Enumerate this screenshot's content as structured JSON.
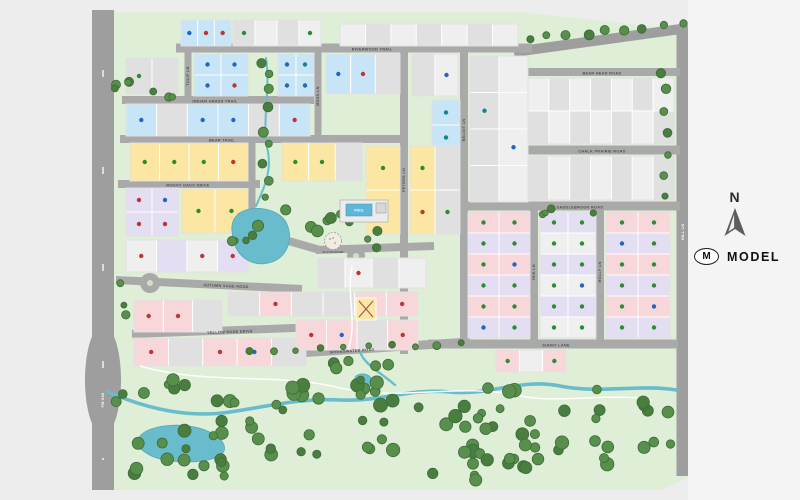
{
  "compass": {
    "label": "N"
  },
  "legend": {
    "symbol": "M",
    "label": "MODEL"
  },
  "amenities": {
    "pool": "POOL",
    "playground": "PLAYGROUND"
  },
  "map": {
    "page_bg": "#ededed",
    "panel_bg": "#f4f4f4",
    "background": "#dfeed6",
    "road_color": "#a9a9a9",
    "main_road_color": "#9e9e9e",
    "water": "#68bccc",
    "water_edge": "#57a7b8",
    "tree_fill": "#598f4c",
    "tree_fill_alt": "#4a7d40",
    "tree_stroke": "#3c6b36",
    "trail_color": "#ffffff",
    "label_color": "#4f4f4f",
    "lot_fills": {
      "blue": "#c7e5f6",
      "yellow": "#fbe7a3",
      "pink": "#f8d7da",
      "lavender": "#e4def2",
      "gray": "#e0e0e0",
      "white": "#efefef"
    },
    "dot_colors": {
      "green": "#2e8b34",
      "blue": "#2167c0",
      "red": "#bf3434",
      "teal": "#0f8792",
      "purple": "#5d3191"
    },
    "streets": [
      {
        "label": "FM 646",
        "x1": 103,
        "y1": 10,
        "x2": 103,
        "y2": 490,
        "w": 22,
        "main": true,
        "vert": true,
        "lx": 103,
        "ly": 400,
        "labelColor": "#ffffff"
      },
      {
        "label": "HILL LN",
        "x1": 683,
        "y1": 28,
        "x2": 683,
        "y2": 476,
        "w": 13,
        "main": true,
        "vert": true,
        "lx": 683,
        "ly": 232,
        "labelColor": "#ffffff"
      },
      {
        "label": "",
        "x1": 514,
        "y1": 52,
        "x2": 688,
        "y2": 28,
        "w": 10,
        "main": true
      },
      {
        "label": "RIVERWOOD TRAIL",
        "x1": 176,
        "y1": 48,
        "x2": 532,
        "y2": 48,
        "w": 9,
        "lx": 372,
        "ly": 49.4
      },
      {
        "label": "BEAR HEAD ROAD",
        "x1": 526,
        "y1": 72,
        "x2": 680,
        "y2": 72,
        "w": 8,
        "lx": 602,
        "ly": 73.4
      },
      {
        "label": "CHALK PRAIRIE ROAD",
        "x1": 526,
        "y1": 150,
        "x2": 680,
        "y2": 150,
        "w": 9,
        "lx": 602,
        "ly": 151.4
      },
      {
        "label": "SADDLEBROOK ROAD",
        "x1": 464,
        "y1": 206,
        "x2": 680,
        "y2": 206,
        "w": 9,
        "lx": 580,
        "ly": 207.4
      },
      {
        "label": "SUNNY LANE",
        "x1": 428,
        "y1": 344,
        "x2": 678,
        "y2": 344,
        "w": 9,
        "lx": 556,
        "ly": 345.4
      },
      {
        "label": "INDIAN GRASS TRAIL",
        "x1": 122,
        "y1": 100,
        "x2": 314,
        "y2": 100,
        "w": 8,
        "lx": 215,
        "ly": 101.4
      },
      {
        "label": "BEAR TRAIL",
        "x1": 120,
        "y1": 139,
        "x2": 406,
        "y2": 139,
        "w": 8,
        "lx": 222,
        "ly": 140.4
      },
      {
        "label": "MOSSY OAKS DRIVE",
        "x1": 118,
        "y1": 184,
        "x2": 260,
        "y2": 184,
        "w": 8,
        "lx": 188,
        "ly": 185.4
      },
      {
        "label": "AUTUMN SAGE ROAD",
        "x1": 116,
        "y1": 280,
        "x2": 302,
        "y2": 289,
        "w": 8,
        "lx": 226,
        "ly": 286,
        "ang": 2.5
      },
      {
        "label": "YELLOW ROSE DRIVE",
        "x1": 132,
        "y1": 334,
        "x2": 320,
        "y2": 327,
        "w": 8,
        "lx": 230,
        "ly": 332,
        "ang": -2
      },
      {
        "label": "SPRINGWATER ROAD",
        "x1": 234,
        "y1": 357,
        "x2": 470,
        "y2": 342,
        "w": 9,
        "lx": 352,
        "ly": 351,
        "ang": -3.5
      },
      {
        "label": "",
        "x1": 250,
        "y1": 230,
        "x2": 320,
        "y2": 250,
        "w": 8
      },
      {
        "label": "",
        "x1": 316,
        "y1": 250,
        "x2": 434,
        "y2": 246,
        "w": 8
      },
      {
        "label": "",
        "x1": 252,
        "y1": 139,
        "x2": 252,
        "y2": 232,
        "w": 7,
        "vert": true
      },
      {
        "label": "TULIP LN",
        "x1": 188,
        "y1": 48,
        "x2": 188,
        "y2": 100,
        "w": 7,
        "vert": true,
        "lx": 188,
        "ly": 76
      },
      {
        "label": "MOSS LN",
        "x1": 318,
        "y1": 48,
        "x2": 318,
        "y2": 139,
        "w": 7,
        "vert": true,
        "lx": 318,
        "ly": 96
      },
      {
        "label": "PETERS LN",
        "x1": 404,
        "y1": 48,
        "x2": 404,
        "y2": 354,
        "w": 8,
        "vert": true,
        "lx": 404,
        "ly": 180
      },
      {
        "label": "BELOIT LN",
        "x1": 464,
        "y1": 48,
        "x2": 464,
        "y2": 344,
        "w": 8,
        "vert": true,
        "lx": 464,
        "ly": 130
      },
      {
        "label": "IRIS LN",
        "x1": 534,
        "y1": 206,
        "x2": 534,
        "y2": 344,
        "w": 8,
        "vert": true,
        "lx": 534,
        "ly": 272
      },
      {
        "label": "HOLLY LN",
        "x1": 600,
        "y1": 206,
        "x2": 600,
        "y2": 344,
        "w": 8,
        "vert": true,
        "lx": 600,
        "ly": 272
      }
    ],
    "culdesacs": [
      {
        "x": 150,
        "y": 283,
        "r": 10,
        "island": true
      },
      {
        "x": 356,
        "y": 256,
        "r": 9,
        "island": true
      }
    ],
    "blocks": [
      {
        "name": "top-left-blue",
        "x": 181,
        "y": 20,
        "w": 50,
        "h": 26,
        "rows": 1,
        "cols": 3,
        "fills": [
          "blue"
        ],
        "dots": [
          "blue",
          "red",
          "red"
        ]
      },
      {
        "name": "top-left-gray",
        "x": 233,
        "y": 20,
        "w": 88,
        "h": 26,
        "rows": 1,
        "cols": 4,
        "fills": [
          "gray",
          "white"
        ],
        "dots": [
          "green",
          null,
          null,
          "green"
        ]
      },
      {
        "name": "top-mid-gray",
        "x": 340,
        "y": 24,
        "w": 178,
        "h": 22,
        "rows": 1,
        "cols": 7,
        "fills": [
          "white",
          "gray"
        ],
        "dots": []
      },
      {
        "name": "nw-gray",
        "x": 126,
        "y": 58,
        "w": 52,
        "h": 36,
        "rows": 1,
        "cols": 2,
        "fills": [
          "gray"
        ],
        "dots": [
          "green",
          null
        ]
      },
      {
        "name": "nw-blue-a",
        "x": 194,
        "y": 54,
        "w": 54,
        "h": 42,
        "rows": 2,
        "cols": 2,
        "fills": [
          "blue"
        ],
        "dots": [
          "blue",
          "blue",
          "blue",
          "red"
        ]
      },
      {
        "name": "nw-blue-b",
        "x": 278,
        "y": 54,
        "w": 36,
        "h": 42,
        "rows": 2,
        "cols": 2,
        "fills": [
          "blue"
        ],
        "dots": [
          "blue",
          "teal",
          "blue",
          "blue"
        ]
      },
      {
        "name": "n-blue-c",
        "x": 326,
        "y": 54,
        "w": 74,
        "h": 40,
        "rows": 1,
        "cols": 3,
        "fills": [
          "blue",
          "blue",
          "gray"
        ],
        "dots": [
          "blue",
          "red",
          null
        ]
      },
      {
        "name": "n-gray-col",
        "x": 412,
        "y": 54,
        "w": 46,
        "h": 42,
        "rows": 1,
        "cols": 2,
        "fills": [
          "gray",
          "white"
        ],
        "dots": [
          null,
          "blue"
        ]
      },
      {
        "name": "beloit-blue-col",
        "x": 432,
        "y": 100,
        "w": 28,
        "h": 100,
        "rows": 4,
        "cols": 1,
        "fills": [
          "blue"
        ],
        "dots": [
          "teal",
          "teal",
          "blue",
          "teal"
        ]
      },
      {
        "name": "beloit-gray-col",
        "x": 470,
        "y": 56,
        "w": 58,
        "h": 146,
        "rows": 4,
        "cols": 2,
        "fills": [
          "gray",
          "white"
        ],
        "dots": [
          null,
          null,
          "teal",
          null,
          null,
          "blue",
          null,
          null
        ]
      },
      {
        "name": "mid-row",
        "x": 126,
        "y": 104,
        "w": 184,
        "h": 32,
        "rows": 1,
        "cols": 6,
        "fills": [
          "blue",
          "gray",
          "blue",
          "blue",
          "gray",
          "blue"
        ],
        "dots": [
          "blue",
          null,
          "blue",
          "blue",
          null,
          "red"
        ]
      },
      {
        "name": "yellow-row-a",
        "x": 130,
        "y": 143,
        "w": 118,
        "h": 38,
        "rows": 1,
        "cols": 4,
        "fills": [
          "yellow"
        ],
        "dots": [
          "green",
          "green",
          "green",
          "red"
        ]
      },
      {
        "name": "yellow-row-b",
        "x": 282,
        "y": 143,
        "w": 80,
        "h": 38,
        "rows": 1,
        "cols": 3,
        "fills": [
          "yellow",
          "yellow",
          "gray"
        ],
        "dots": [
          "green",
          "green",
          null
        ]
      },
      {
        "name": "yellow-col-c",
        "x": 366,
        "y": 146,
        "w": 34,
        "h": 88,
        "rows": 2,
        "cols": 1,
        "fills": [
          "yellow"
        ],
        "dots": [
          "green",
          "red"
        ]
      },
      {
        "name": "yellow-col-d",
        "x": 410,
        "y": 146,
        "w": 50,
        "h": 88,
        "rows": 2,
        "cols": 2,
        "fills": [
          "yellow",
          "gray"
        ],
        "dots": [
          "green",
          null,
          "red",
          "green"
        ]
      },
      {
        "name": "lavender-left",
        "x": 126,
        "y": 188,
        "w": 52,
        "h": 48,
        "rows": 2,
        "cols": 2,
        "fills": [
          "lavender"
        ],
        "dots": [
          "red",
          "blue",
          "red",
          "red"
        ]
      },
      {
        "name": "yellow-wedge",
        "x": 182,
        "y": 189,
        "w": 66,
        "h": 44,
        "rows": 1,
        "cols": 2,
        "fills": [
          "yellow"
        ],
        "dots": [
          "green",
          "green"
        ]
      },
      {
        "name": "left-row-3",
        "x": 126,
        "y": 240,
        "w": 122,
        "h": 32,
        "rows": 1,
        "cols": 4,
        "fills": [
          "white",
          "lavender"
        ],
        "dots": [
          "red",
          null,
          "red",
          "red"
        ]
      },
      {
        "name": "gray-mid-south",
        "x": 318,
        "y": 258,
        "w": 108,
        "h": 30,
        "rows": 1,
        "cols": 4,
        "fills": [
          "gray",
          "white"
        ],
        "dots": [
          null,
          "red",
          null,
          null
        ]
      },
      {
        "name": "pink-row-mid",
        "x": 228,
        "y": 292,
        "w": 190,
        "h": 24,
        "rows": 1,
        "cols": 6,
        "fills": [
          "gray",
          "pink",
          "gray",
          "gray",
          "pink",
          "pink"
        ],
        "dots": [
          null,
          "red",
          null,
          null,
          "red",
          "red"
        ]
      },
      {
        "name": "pink-sw-a",
        "x": 134,
        "y": 300,
        "w": 88,
        "h": 32,
        "rows": 1,
        "cols": 3,
        "fills": [
          "pink",
          "pink",
          "gray"
        ],
        "dots": [
          "red",
          "red",
          null
        ]
      },
      {
        "name": "pink-sw-b",
        "x": 134,
        "y": 338,
        "w": 172,
        "h": 28,
        "rows": 1,
        "cols": 5,
        "fills": [
          "pink",
          "gray",
          "pink",
          "pink",
          "gray"
        ],
        "dots": [
          "red",
          null,
          "red",
          "blue",
          null
        ]
      },
      {
        "name": "pink-s-mid",
        "x": 296,
        "y": 320,
        "w": 122,
        "h": 30,
        "rows": 1,
        "cols": 4,
        "fills": [
          "pink",
          "pink",
          "gray",
          "pink"
        ],
        "dots": [
          "red",
          "blue",
          null,
          "red"
        ]
      },
      {
        "name": "tr-row-1",
        "x": 528,
        "y": 78,
        "w": 146,
        "h": 66,
        "rows": 2,
        "cols": 7,
        "fills": [
          "white",
          "gray"
        ],
        "dots": []
      },
      {
        "name": "tr-row-2",
        "x": 528,
        "y": 156,
        "w": 146,
        "h": 44,
        "rows": 1,
        "cols": 7,
        "fills": [
          "gray",
          "white"
        ],
        "dots": []
      },
      {
        "name": "sec-1",
        "x": 468,
        "y": 212,
        "w": 62,
        "h": 126,
        "rows": 6,
        "cols": 2,
        "fills": [
          "pink",
          "pink",
          "lavender",
          "lavender"
        ],
        "dots": [
          "green",
          "green",
          "green",
          "green",
          "green",
          "blue",
          "green",
          "green",
          "green",
          "green",
          "blue",
          "green"
        ]
      },
      {
        "name": "sec-2",
        "x": 540,
        "y": 212,
        "w": 56,
        "h": 126,
        "rows": 6,
        "cols": 2,
        "fills": [
          "lavender",
          "lavender",
          "white",
          "white"
        ],
        "dots": [
          "green",
          "green",
          "green",
          "green",
          "green",
          "green",
          "green",
          "blue",
          "green",
          "green",
          "green",
          "green"
        ]
      },
      {
        "name": "sec-3",
        "x": 606,
        "y": 212,
        "w": 64,
        "h": 126,
        "rows": 6,
        "cols": 2,
        "fills": [
          "pink",
          "pink",
          "lavender",
          "lavender"
        ],
        "dots": [
          "green",
          "green",
          "blue",
          "green",
          "green",
          "green",
          "green",
          "green",
          "green",
          "blue",
          "green",
          "green"
        ]
      },
      {
        "name": "se-below",
        "x": 496,
        "y": 350,
        "w": 70,
        "h": 22,
        "rows": 1,
        "cols": 3,
        "fills": [
          "pink",
          "white",
          "pink"
        ],
        "dots": [
          "green",
          null,
          "green"
        ]
      }
    ],
    "model_lot": {
      "x": 356,
      "y": 298,
      "w": 20,
      "h": 22,
      "fill": "yellow"
    },
    "tree_clusters": [
      {
        "x1": 530,
        "y1": 40,
        "x2": 682,
        "y2": 24,
        "n": 9,
        "j": 3,
        "rmin": 3.5,
        "rmax": 5.5
      },
      {
        "x1": 266,
        "y1": 60,
        "x2": 266,
        "y2": 196,
        "n": 9,
        "j": 6,
        "rmin": 3,
        "rmax": 5
      },
      {
        "x1": 664,
        "y1": 70,
        "x2": 664,
        "y2": 200,
        "n": 7,
        "j": 4,
        "rmin": 3,
        "rmax": 5
      },
      {
        "x1": 250,
        "y1": 352,
        "x2": 462,
        "y2": 342,
        "n": 10,
        "j": 3,
        "rmin": 2.5,
        "rmax": 4
      },
      {
        "cx": 262,
        "cy": 225,
        "rx": 30,
        "ry": 20,
        "n": 6,
        "rmin": 3,
        "rmax": 6
      },
      {
        "cx": 330,
        "cy": 222,
        "rx": 40,
        "ry": 16,
        "n": 7,
        "rmin": 3,
        "rmax": 6
      },
      {
        "cx": 372,
        "cy": 240,
        "rx": 25,
        "ry": 10,
        "n": 4,
        "rmin": 3,
        "rmax": 5
      },
      {
        "cx": 122,
        "cy": 80,
        "rx": 8,
        "ry": 28,
        "n": 4,
        "rmin": 3,
        "rmax": 5
      },
      {
        "cx": 160,
        "cy": 96,
        "rx": 20,
        "ry": 6,
        "n": 3,
        "rmin": 3,
        "rmax": 4.5
      },
      {
        "cx": 120,
        "cy": 300,
        "rx": 8,
        "ry": 20,
        "n": 3,
        "rmin": 3,
        "rmax": 4.5
      },
      {
        "cx": 566,
        "cy": 211,
        "rx": 34,
        "ry": 4,
        "n": 4,
        "rmin": 2.5,
        "rmax": 4
      },
      {
        "cx": 170,
        "cy": 452,
        "rx": 55,
        "ry": 25,
        "n": 14,
        "rmin": 4,
        "rmax": 7
      },
      {
        "cx": 150,
        "cy": 394,
        "rx": 35,
        "ry": 16,
        "n": 7,
        "rmin": 4,
        "rmax": 6.5
      },
      {
        "cx": 262,
        "cy": 428,
        "rx": 60,
        "ry": 35,
        "n": 16,
        "rmin": 4,
        "rmax": 7
      },
      {
        "cx": 330,
        "cy": 400,
        "rx": 50,
        "ry": 25,
        "n": 12,
        "rmin": 4,
        "rmax": 7
      },
      {
        "cx": 420,
        "cy": 430,
        "rx": 55,
        "ry": 35,
        "n": 14,
        "rmin": 4,
        "rmax": 7
      },
      {
        "cx": 510,
        "cy": 402,
        "rx": 55,
        "ry": 30,
        "n": 12,
        "rmin": 4,
        "rmax": 7
      },
      {
        "cx": 560,
        "cy": 452,
        "rx": 55,
        "ry": 25,
        "n": 12,
        "rmin": 4,
        "rmax": 7
      },
      {
        "cx": 630,
        "cy": 420,
        "rx": 42,
        "ry": 40,
        "n": 12,
        "rmin": 4,
        "rmax": 7
      },
      {
        "cx": 470,
        "cy": 464,
        "rx": 40,
        "ry": 18,
        "n": 8,
        "rmin": 4,
        "rmax": 6.5
      },
      {
        "cx": 360,
        "cy": 370,
        "rx": 30,
        "ry": 10,
        "n": 6,
        "rmin": 3.5,
        "rmax": 6
      }
    ],
    "creeks": [
      {
        "d": "M108,392 C150,410 190,418 230,412 C270,406 300,398 340,400 C380,402 410,388 450,392 C490,396 520,378 560,386 C600,394 640,384 676,390",
        "w": 3.6
      },
      {
        "d": "M360,352 C365,365 380,372 395,385",
        "w": 2.4
      },
      {
        "d": "M266,58 C271,92 261,122 268,152 C272,174 262,192 256,206",
        "w": 2
      }
    ],
    "ponds": [
      {
        "d": "M238,214 C252,204 278,208 286,222 C294,238 288,256 272,262 C254,268 238,258 234,242 C231,230 230,222 238,214 Z"
      },
      {
        "d": "M140,436 C150,424 185,422 205,430 C225,438 232,452 215,458 C195,465 160,462 148,454 C138,448 134,444 140,436 Z"
      },
      {
        "d": "M356,376 C362,372 370,374 372,380 C374,386 368,390 361,388 C355,386 353,380 356,376 Z"
      }
    ],
    "trails": [
      "M140,366 C210,386 280,372 340,388 C400,402 460,382 520,396 C560,404 610,392 652,400",
      "M352,266 C346,296 358,322 348,350"
    ]
  }
}
